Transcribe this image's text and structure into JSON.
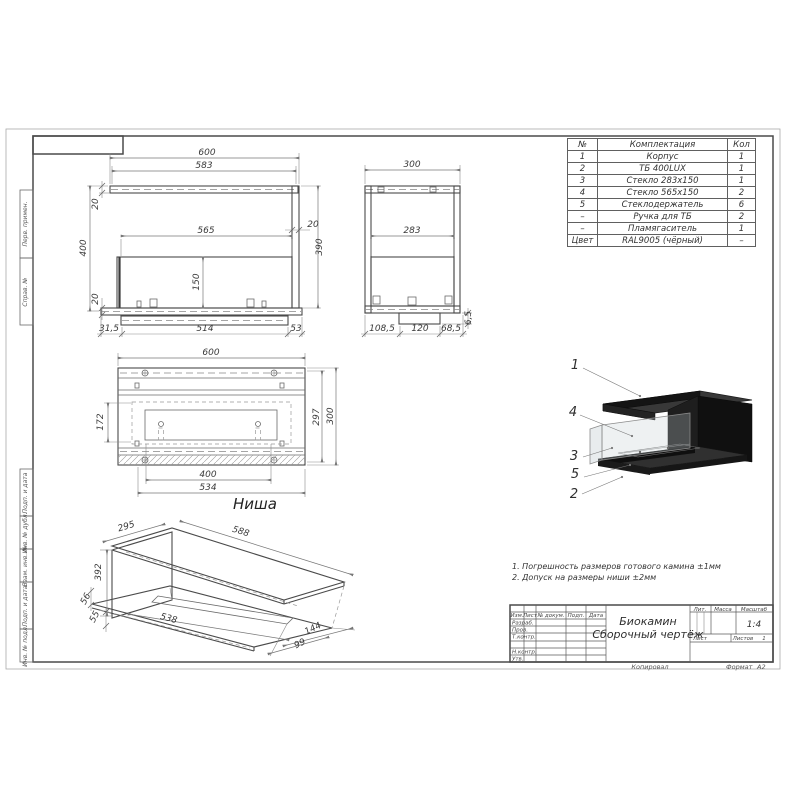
{
  "sheet": {
    "copied_label": "Копировал",
    "format_label": "Формат",
    "format_value": "А2"
  },
  "parts_table": {
    "headers": [
      "№",
      "Комплектация",
      "Кол"
    ],
    "rows": [
      [
        "1",
        "Корпус",
        "1"
      ],
      [
        "2",
        "ТБ 400LUX",
        "1"
      ],
      [
        "3",
        "Стекло 283х150",
        "1"
      ],
      [
        "4",
        "Стекло 565х150",
        "2"
      ],
      [
        "5",
        "Стеклодержатель",
        "6"
      ],
      [
        "–",
        "Ручка для ТБ",
        "2"
      ],
      [
        "–",
        "Пламягаситель",
        "1"
      ],
      [
        "Цвет",
        "RAL9005 (чёрный)",
        "–"
      ]
    ]
  },
  "notes": [
    "1. Погрешность размеров готового камина ±1мм",
    "2. Допуск на размеры ниши ±2мм"
  ],
  "views": {
    "niche_label": "Ниша"
  },
  "dimensions": {
    "f600": "600",
    "f583": "583",
    "f400": "400",
    "f20t": "20",
    "f565": "565",
    "f20r": "20",
    "f390": "390",
    "f150": "150",
    "f20b": "20",
    "f315": "31,5",
    "f514": "514",
    "f53": "53",
    "s300": "300",
    "s283": "283",
    "s65": "6,5",
    "s1085": "108,5",
    "s120": "120",
    "s685": "68,5",
    "p600": "600",
    "p172": "172",
    "p297": "297",
    "p300": "300",
    "p400": "400",
    "p534": "534",
    "n295": "295",
    "n588": "588",
    "n392": "392",
    "n56": "56",
    "n55": "55",
    "n538": "538",
    "n99": "99",
    "n144": "144"
  },
  "callouts": [
    "1",
    "4",
    "3",
    "5",
    "2"
  ],
  "margin_labels": [
    "Перв. примен.",
    "Справ. №",
    "Подп. и дата",
    "Инв. № дубл.",
    "Взам. инв. №",
    "Подп. и дата",
    "Инв. № подл."
  ],
  "title_block": {
    "doc_title_line1": "Биокамин",
    "doc_title_line2": "Сборочный чертёж",
    "col_izm": "Изм.",
    "col_list": "Лист",
    "col_ndoc": "№ докум.",
    "col_podp": "Подп.",
    "col_data": "Дата",
    "row_labels": [
      "Разраб.",
      "Пров.",
      "Т.контр.",
      "",
      "Н.контр.",
      "Утв."
    ],
    "lit_label": "Лит.",
    "mass_label": "Масса",
    "scale_label": "Масштаб",
    "scale_value": "1:4",
    "sheet_label": "Лист",
    "sheets_label": "Листов",
    "sheets_value": "1"
  }
}
